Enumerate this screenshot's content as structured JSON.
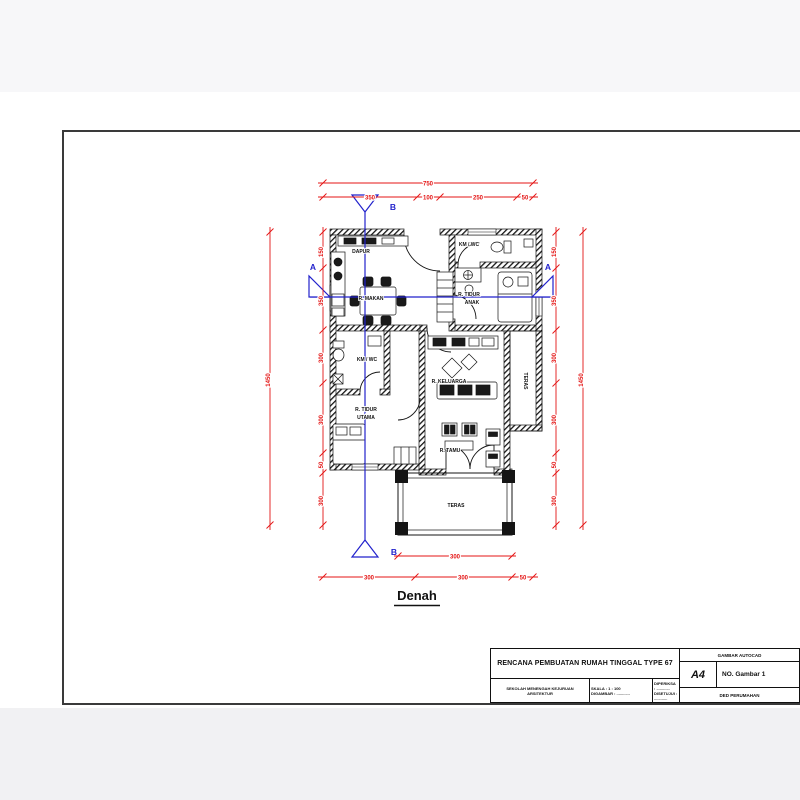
{
  "sheet": {
    "caption": "Denah",
    "title_block": {
      "project_title": "RENCANA PEMBUATAN RUMAH TINGGAL TYPE 67",
      "org_line1": "SEKOLAH MENENGAH KEJURUAN",
      "org_line2": "ARSITEKTUR",
      "scale_line": "SKALA : 1 : 100",
      "drawn_line": "DIGAMBAR : ............",
      "checked_line": "DIPERIKSA : ............",
      "approved_line": "DISETUJUI : ............",
      "header_label": "GAMBAR AUTOCAD",
      "paper_size": "A4",
      "sheet_no": "NO. Gambar 1",
      "footer_label": "DED PERUMAHAN"
    },
    "plan": {
      "rooms": {
        "dapur": "DAPUR",
        "kmwc1": "KM / WC",
        "makan": "R. MAKAN",
        "tidur_anak": [
          "R. TIDUR",
          "ANAK"
        ],
        "kmwc2": "KM / WC",
        "keluarga": "R. KELUARGA",
        "teras_side": "TERAS",
        "tidur_utama": [
          "R. TIDUR",
          "UTAMA"
        ],
        "tamu": "R. TAMU",
        "teras_front": "TERAS"
      },
      "sections": {
        "a": "A",
        "b": "B"
      },
      "dims": {
        "top_total": "750",
        "top_segments": [
          "350",
          "100",
          "250",
          "50"
        ],
        "left_total": "1450",
        "left_segments": [
          "150",
          "350",
          "300",
          "300",
          "50",
          "300"
        ],
        "right_total": "1450",
        "right_segments": [
          "150",
          "350",
          "300",
          "300",
          "50",
          "300"
        ],
        "bottom_inner": "300",
        "bottom_segments": [
          "300",
          "300",
          "50"
        ]
      },
      "colors": {
        "dimension": "#e41414",
        "section": "#2222cc",
        "wall": "#141414"
      }
    }
  }
}
